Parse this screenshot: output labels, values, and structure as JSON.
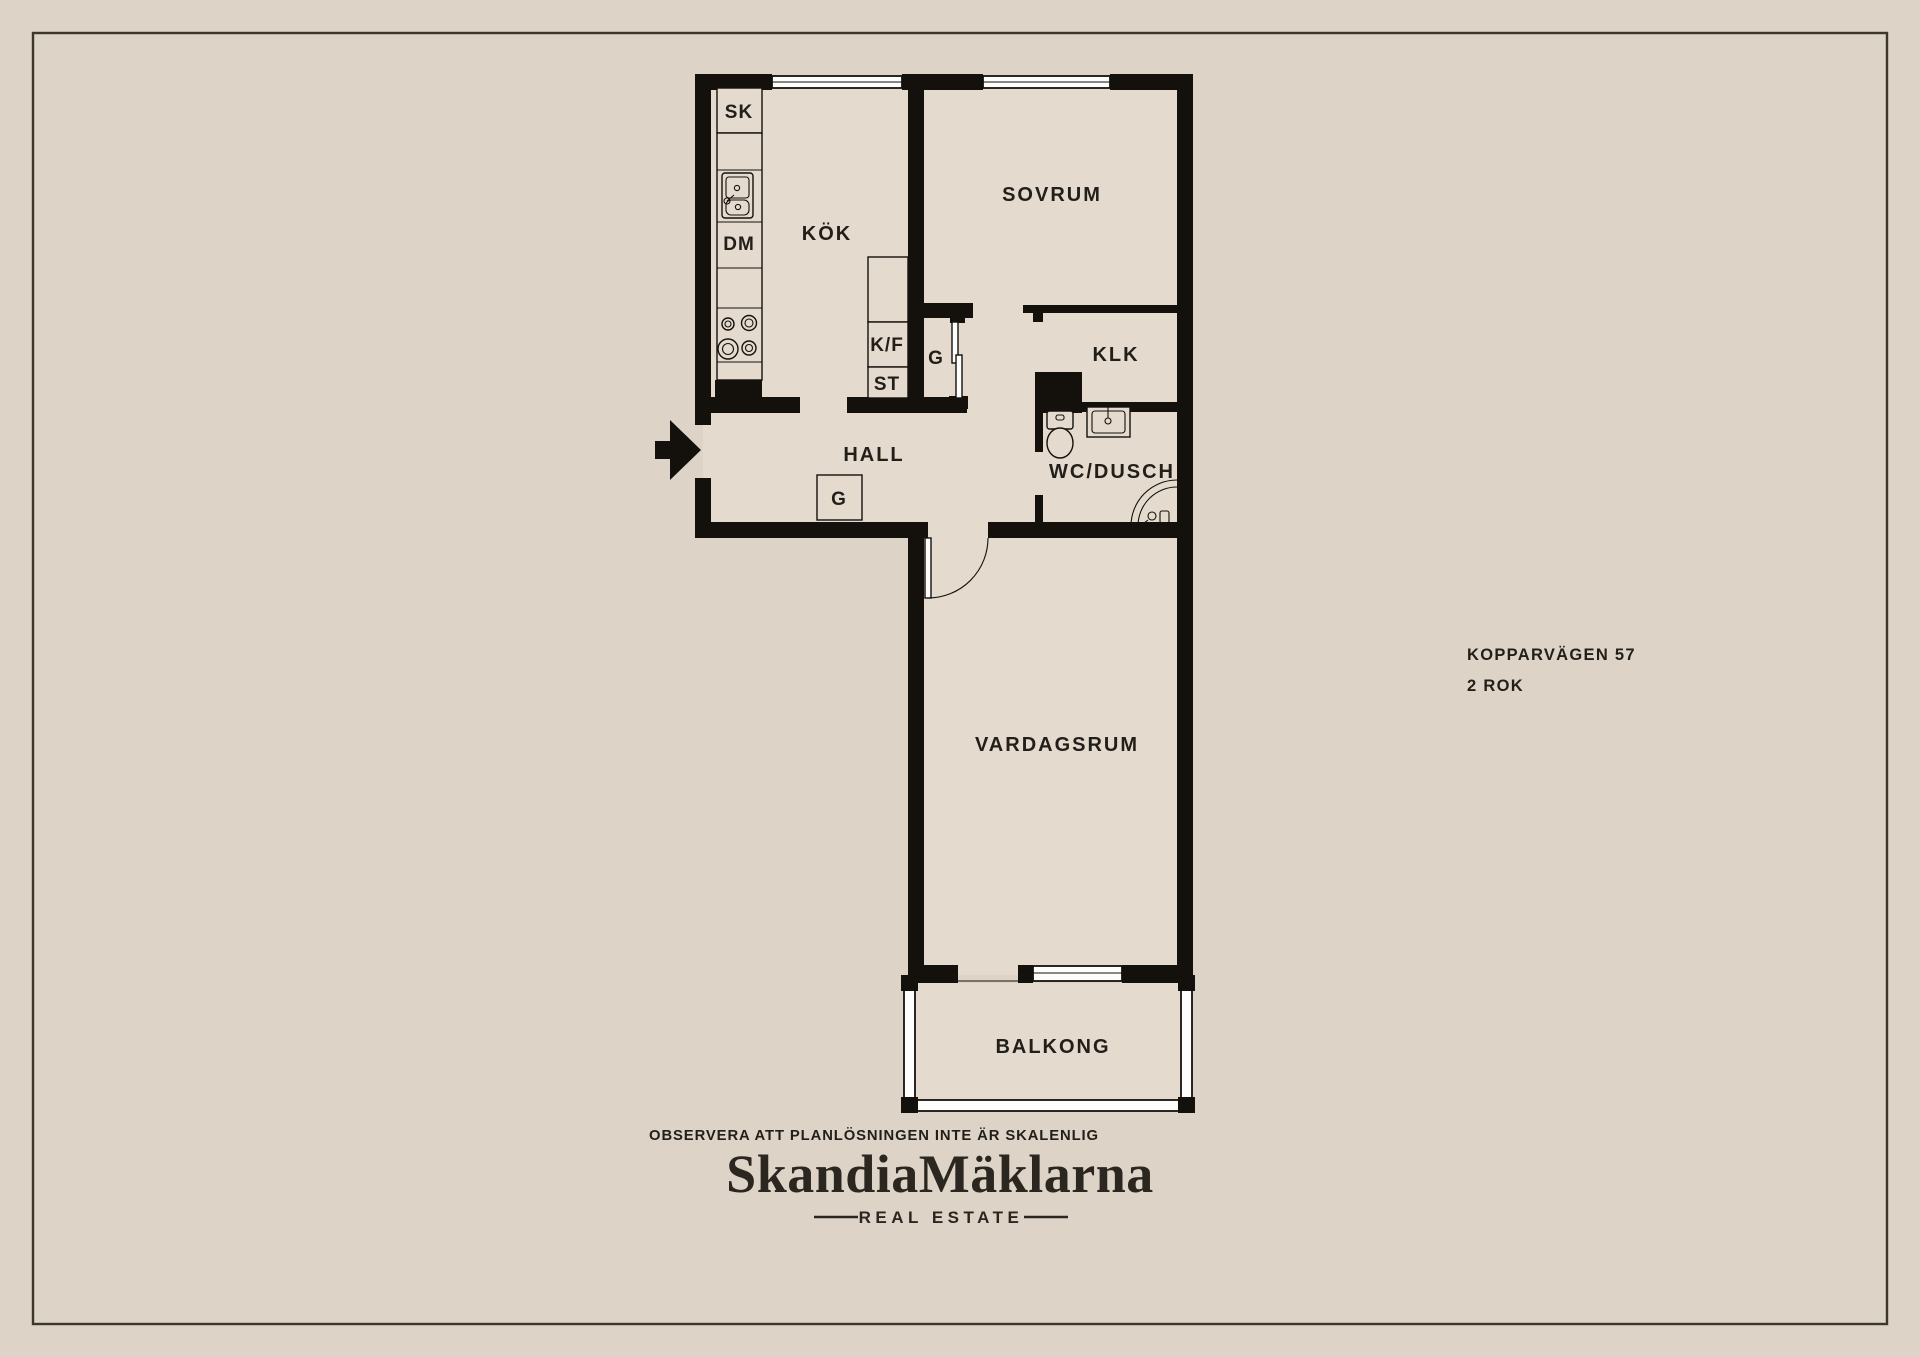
{
  "plan": {
    "rooms": {
      "kok": "KÖK",
      "sovrum": "SOVRUM",
      "klk": "KLK",
      "hall": "HALL",
      "wc": "WC/DUSCH",
      "vardagsrum": "VARDAGSRUM",
      "balkong": "BALKONG"
    },
    "fixtures": {
      "sk": "SK",
      "dm": "DM",
      "kf": "K/F",
      "st": "ST",
      "g_closet": "G",
      "g_hall": "G"
    }
  },
  "header": {
    "address_line1": "KOPPARVÄGEN 57",
    "address_line2": "2 ROK"
  },
  "footer": {
    "disclaimer": "OBSERVERA ATT PLANLÖSNINGEN INTE ÄR SKALENLIG",
    "brand": "SkandiaMäklarna",
    "tagline": "REAL ESTATE"
  },
  "colors": {
    "background": "#ddd3c6",
    "room": "#e4dacd",
    "wall": "#14110d",
    "text": "#221f1a",
    "window": "#fdfdfc",
    "frame": "#3c362c",
    "brand": "#2b2620"
  }
}
